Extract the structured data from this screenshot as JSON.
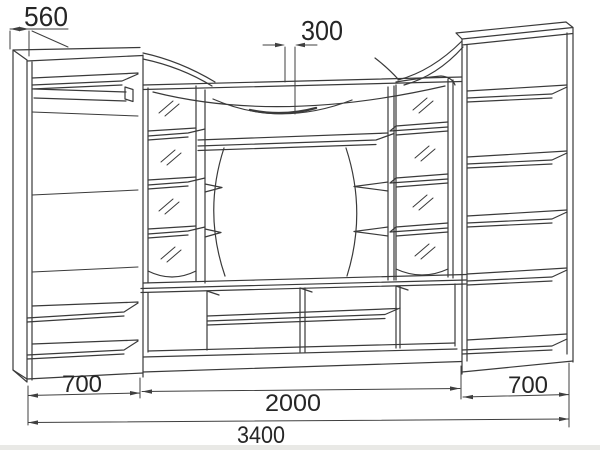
{
  "drawing": {
    "background": "#ffffff",
    "line_color": "#3a3a3a",
    "description": "Front elevation technical drawing of a living-room wall unit (wardrobe, mirrored columns, TV niche, shelf cabinet) with millimeter dimensions"
  },
  "dimensions": {
    "d560": {
      "value": "560",
      "position": "top-left cabinet depth"
    },
    "d300": {
      "value": "300",
      "position": "top-center canopy depth"
    },
    "d700_left": {
      "value": "700",
      "position": "bottom - left wardrobe width"
    },
    "d2000": {
      "value": "2000",
      "position": "bottom - center section width"
    },
    "d700_right": {
      "value": "700",
      "position": "bottom - right cabinet width"
    },
    "d3400": {
      "value": "3400",
      "position": "bottom - overall width"
    }
  }
}
